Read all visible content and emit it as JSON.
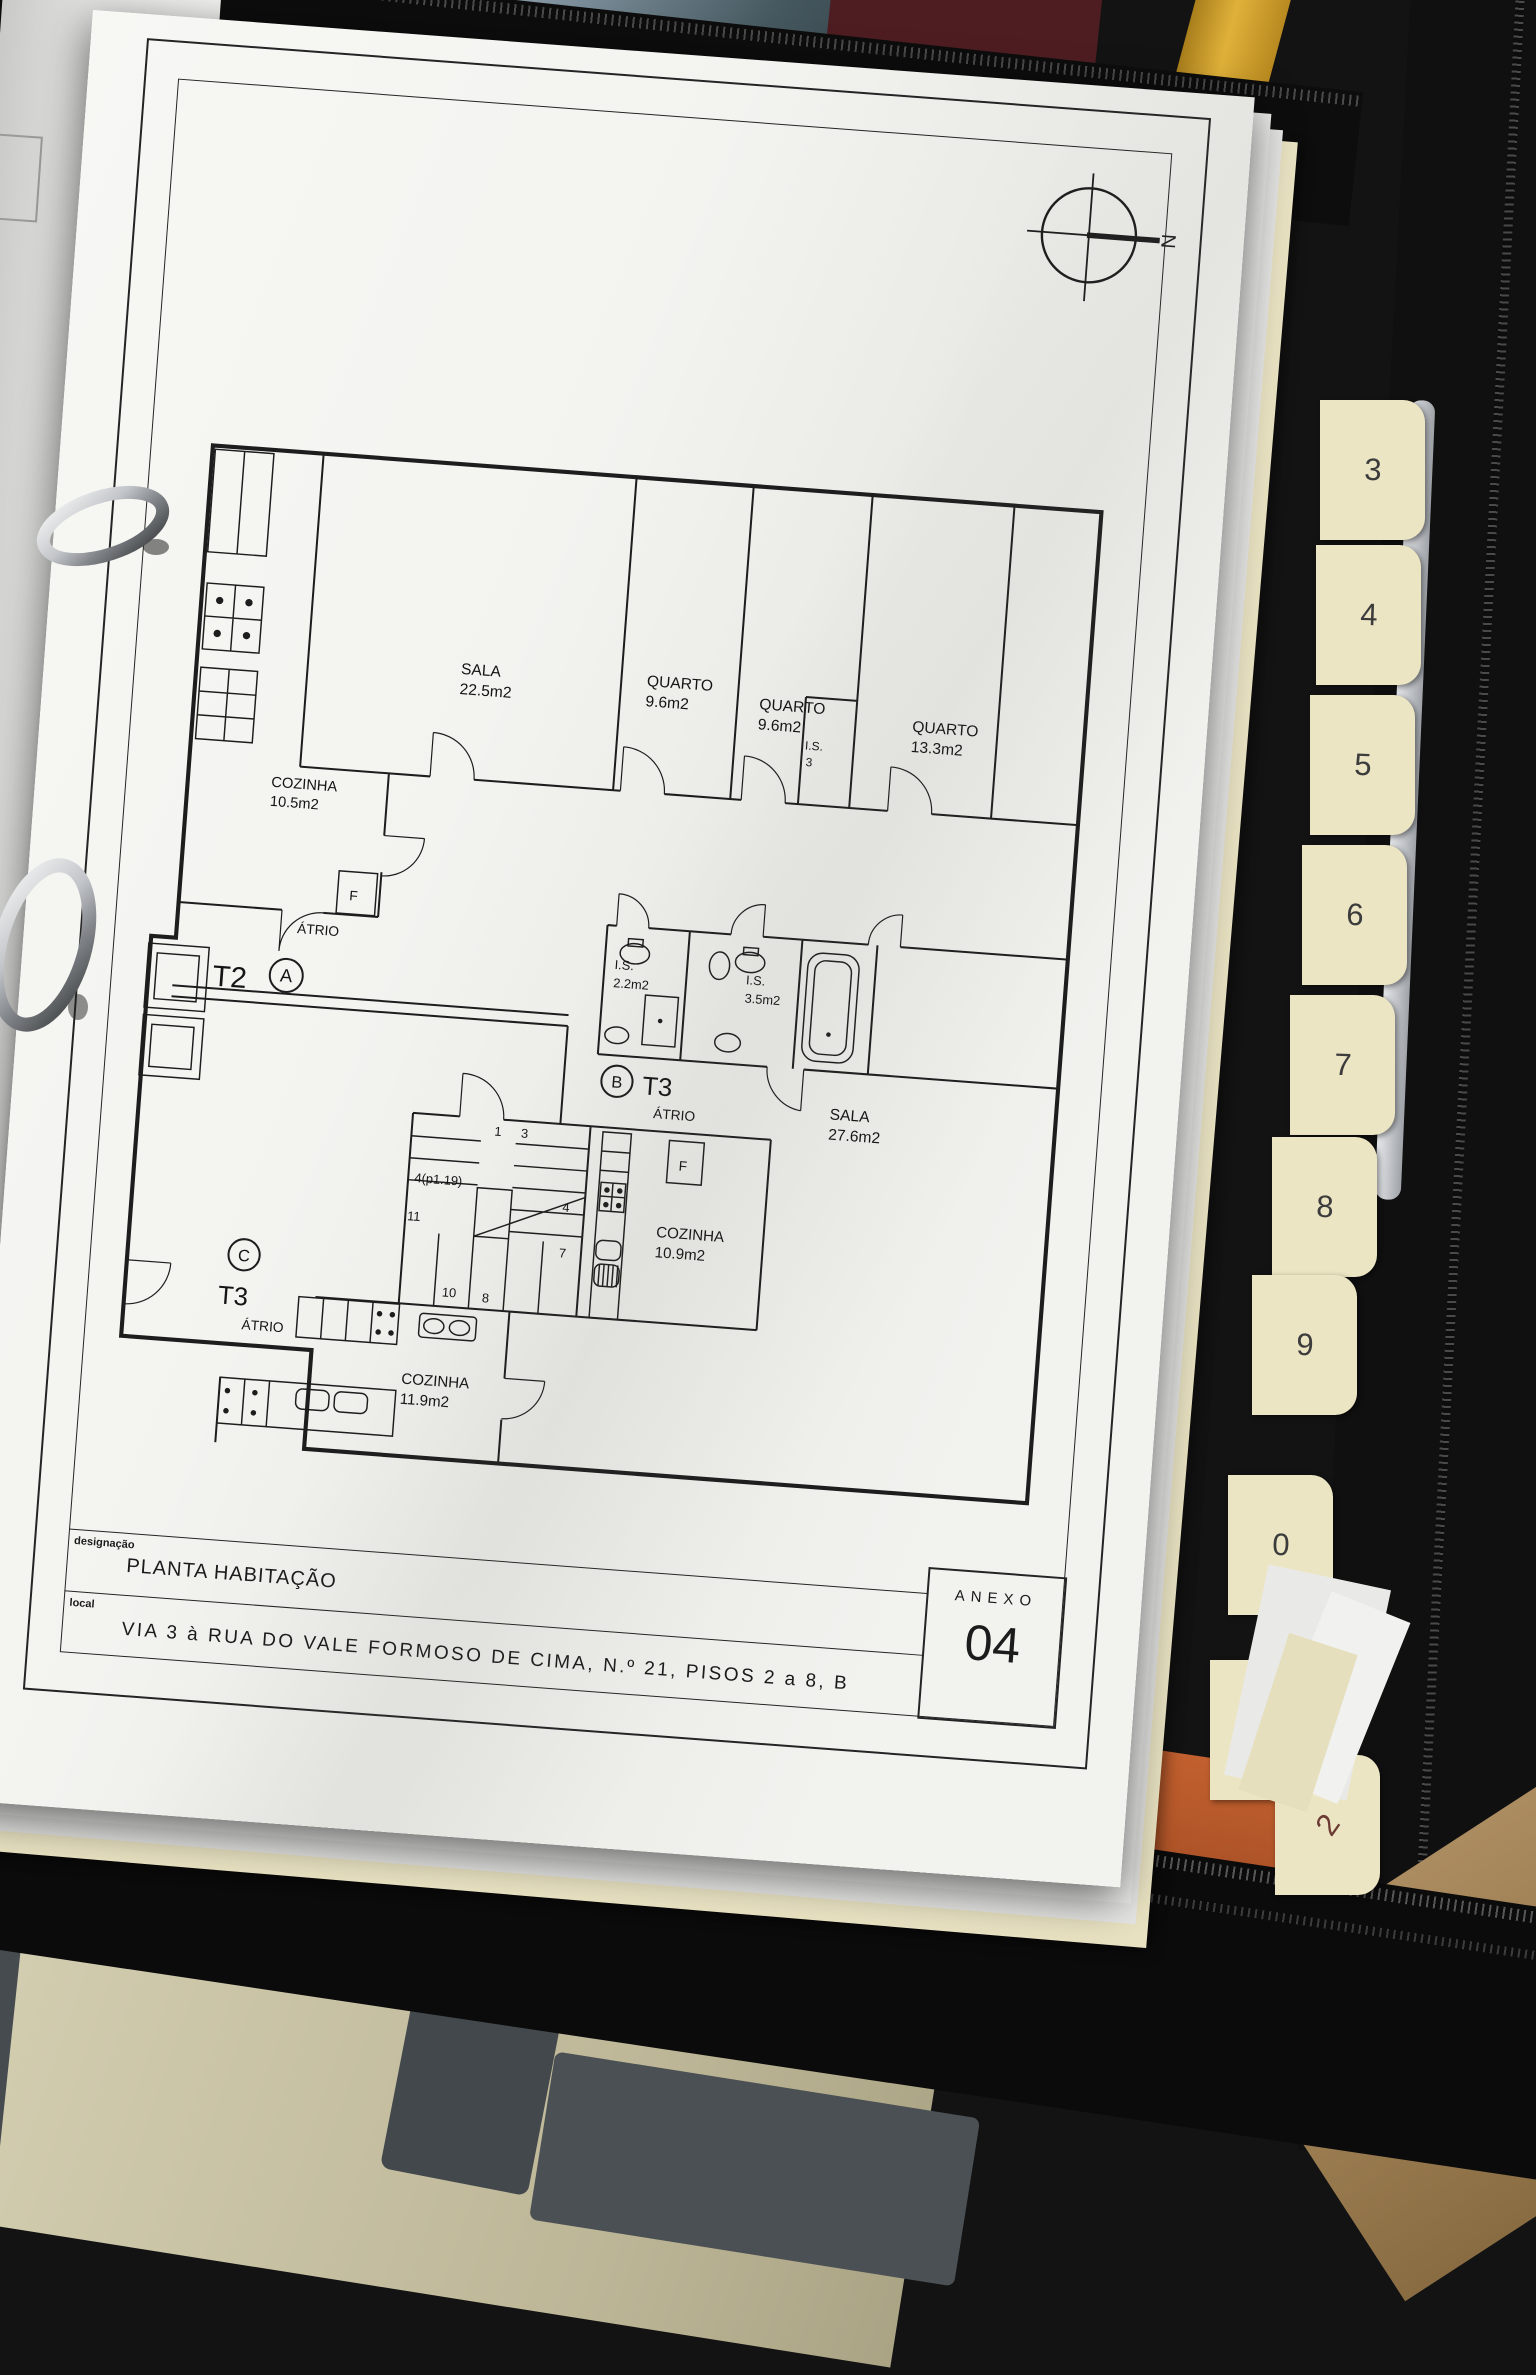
{
  "plan": {
    "north": "N",
    "appliance_label": "F",
    "rooms": {
      "sala_t2": {
        "name": "SALA",
        "area": "22.5m2"
      },
      "quarto_1": {
        "name": "QUARTO",
        "area": "9.6m2"
      },
      "quarto_2": {
        "name": "QUARTO",
        "area": "9.6m2"
      },
      "quarto_3": {
        "name": "QUARTO",
        "area": "13.3m2"
      },
      "cozinha_t2": {
        "name": "COZINHA",
        "area": "10.5m2"
      },
      "atrio_t2": {
        "name": "ÁTRIO"
      },
      "is_corridor": {
        "name": "I.S.",
        "area": "3"
      },
      "is_a": {
        "name": "I.S.",
        "area": "2.2m2"
      },
      "is_b": {
        "name": "I.S.",
        "area": "3.5m2"
      },
      "sala_t3b": {
        "name": "SALA",
        "area": "27.6m2"
      },
      "cozinha_t3b": {
        "name": "COZINHA",
        "area": "10.9m2"
      },
      "atrio_t3b": {
        "name": "ÁTRIO"
      },
      "cozinha_t3c": {
        "name": "COZINHA",
        "area": "11.9m2"
      },
      "atrio_t3c": {
        "name": "ÁTRIO"
      }
    },
    "units": {
      "t2": {
        "label": "T2",
        "letter": "A"
      },
      "t3b": {
        "label": "T3",
        "letter": "B"
      },
      "t3c": {
        "label": "T3",
        "letter": "C"
      }
    },
    "stairs": [
      "1",
      "3",
      "4(p1.19)",
      "11",
      "4",
      "7",
      "10",
      "8"
    ]
  },
  "titleblock": {
    "designation_label": "designação",
    "designation": "PLANTA HABITAÇÃO",
    "location_label": "local",
    "location": "VIA 3 à RUA DO VALE FORMOSO DE CIMA, N.º 21, PISOS 2 a 8, B",
    "annex_label": "ANEXO",
    "annex_number": "04"
  },
  "binder": {
    "tabs": [
      "3",
      "4",
      "5",
      "6",
      "7",
      "8",
      "9",
      "0",
      "0",
      "2"
    ]
  },
  "surroundings": {
    "planner_words_left": [
      "Lundi",
      "Montag",
      "Lunes"
    ],
    "planner_words_right": [
      "Ma",
      "Di",
      "M"
    ],
    "planner_words_bottom": [
      "di",
      "day"
    ]
  },
  "colors": {
    "paper": "#f3f3f0",
    "ink": "#1d1d1d",
    "binder": "#111111",
    "tab": "#ece5c4",
    "folder_orange": "#b85a33",
    "planner": "#cdc7aa",
    "desk": "#97794f"
  }
}
